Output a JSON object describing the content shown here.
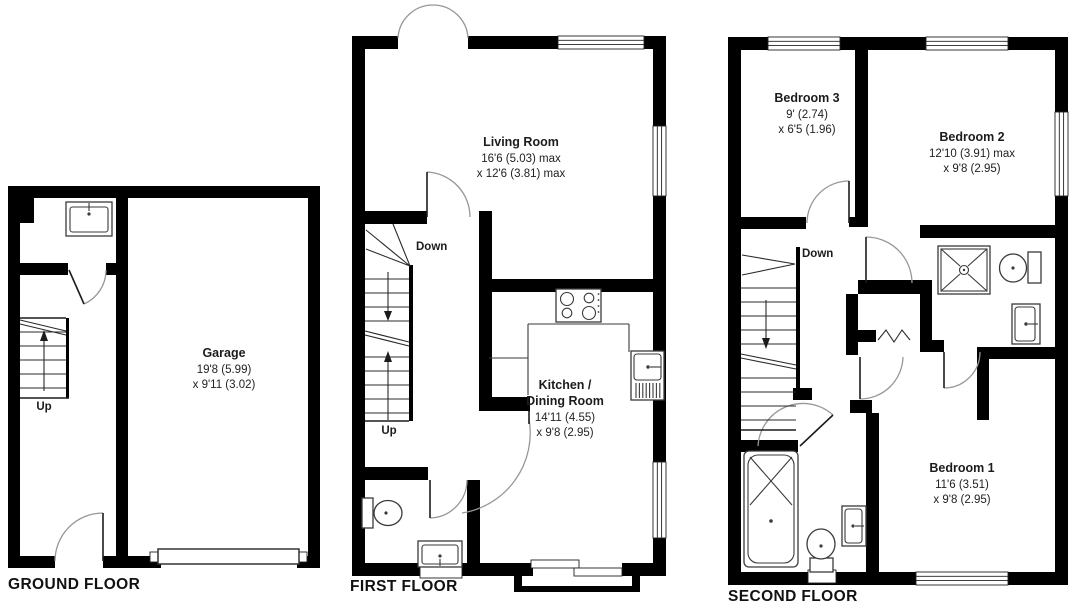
{
  "colors": {
    "background": "#ffffff",
    "walls": "#000000",
    "text": "#1c1c1c",
    "door_arc": "#979797",
    "fixtures": "#3a3a3a"
  },
  "floors": {
    "ground": {
      "label": "GROUND FLOOR",
      "garage": {
        "name": "Garage",
        "dim1": "19'8 (5.99)",
        "dim2": "x 9'11 (3.02)"
      },
      "stairs_up": "Up"
    },
    "first": {
      "label": "FIRST FLOOR",
      "living": {
        "name": "Living Room",
        "dim1": "16'6 (5.03) max",
        "dim2": "x 12'6 (3.81) max"
      },
      "kitchen": {
        "name1": "Kitchen /",
        "name2": "Dining Room",
        "dim1": "14'11 (4.55)",
        "dim2": "x 9'8 (2.95)"
      },
      "stairs_down": "Down",
      "stairs_up": "Up"
    },
    "second": {
      "label": "SECOND FLOOR",
      "bedroom3": {
        "name": "Bedroom 3",
        "dim1": "9' (2.74)",
        "dim2": "x 6'5 (1.96)"
      },
      "bedroom2": {
        "name": "Bedroom 2",
        "dim1": "12'10 (3.91) max",
        "dim2": "x 9'8 (2.95)"
      },
      "bedroom1": {
        "name": "Bedroom 1",
        "dim1": "11'6 (3.51)",
        "dim2": "x 9'8 (2.95)"
      },
      "stairs_down": "Down"
    }
  }
}
